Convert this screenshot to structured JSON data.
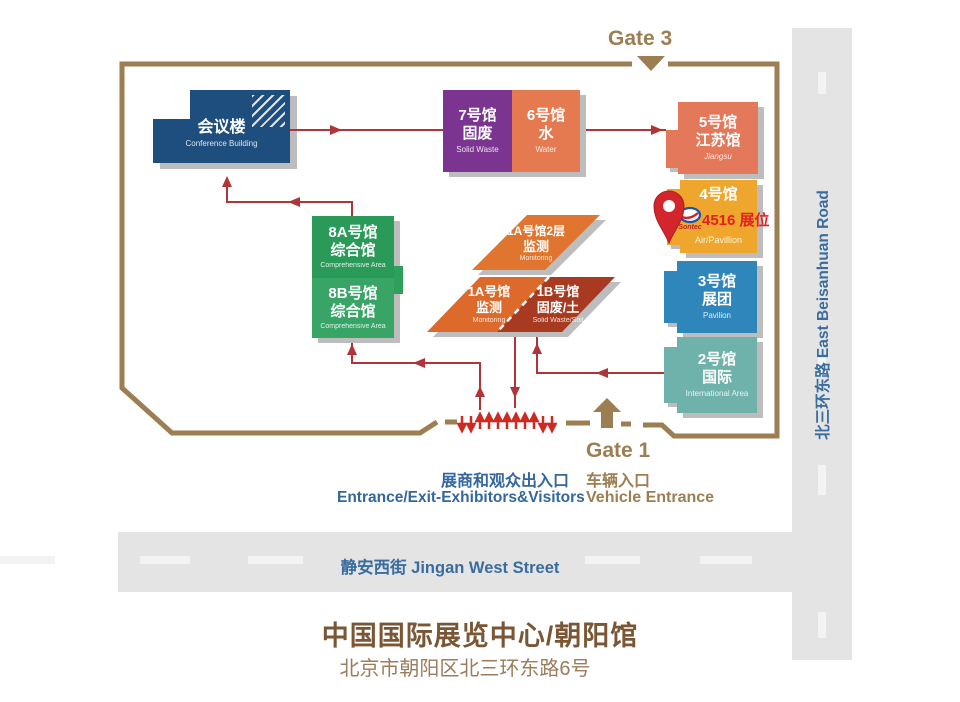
{
  "palette": {
    "border_tan": "#9c7e52",
    "route_red": "#b03438",
    "accent_red": "#d2262c",
    "text_blue": "#33679e",
    "title_brown": "#7b5634",
    "road_gray": "#e4e4e4",
    "hall_conference": "#1e4e7d",
    "hall_7": "#7b3590",
    "hall_6": "#e5794f",
    "hall_5": "#e4785a",
    "hall_4": "#efa62c",
    "hall_3": "#2f86ba",
    "hall_2": "#6fb2ac",
    "hall_8a": "#2a9a59",
    "hall_8b": "#38a567",
    "hall_1a2": "#df752e",
    "hall_1a": "#dd6a2b",
    "hall_1b": "#a73a21"
  },
  "gates": {
    "gate3": "Gate 3",
    "gate1": "Gate 1"
  },
  "halls": {
    "conference": {
      "line1": "会议楼",
      "line3": "Conference Building"
    },
    "h7": {
      "line1": "7号馆",
      "line2": "固废",
      "line3": "Solid Waste"
    },
    "h6": {
      "line1": "6号馆",
      "line2": "水",
      "line3": "Water"
    },
    "h5": {
      "line1": "5号馆",
      "line2": "江苏馆",
      "line3": "Jiangsu"
    },
    "h4": {
      "line1": "4号馆",
      "line3": "Air/Pavillion"
    },
    "h3": {
      "line1": "3号馆",
      "line2": "展团",
      "line3": "Pavilion"
    },
    "h2": {
      "line1": "2号馆",
      "line2": "国际",
      "line3": "International Area"
    },
    "h8a": {
      "line1": "8A号馆",
      "line2": "综合馆",
      "line3": "Comprehensive Area"
    },
    "h8b": {
      "line1": "8B号馆",
      "line2": "综合馆",
      "line3": "Comprehensive Area"
    },
    "h1a2": {
      "line1": "1A号馆2层",
      "line2": "监测",
      "line3": "Monitoring"
    },
    "h1a": {
      "line1": "1A号馆",
      "line2": "监测",
      "line3": "Monitoring"
    },
    "h1b": {
      "line1": "1B号馆",
      "line2": "固废/土",
      "line3": "Solid Waste/Soil"
    }
  },
  "booth": {
    "label": "4516 展位",
    "logo_text": "Sontec"
  },
  "entrance": {
    "cn": "展商和观众出入口",
    "en": "Entrance/Exit-Exhibitors&Visitors"
  },
  "vehicle": {
    "cn": "车辆入口",
    "en": "Vehicle Entrance"
  },
  "streets": {
    "bottom": "静安西街 Jingan West Street",
    "right": "北三环东路 East Beisanhuan Road"
  },
  "footer": {
    "title": "中国国际展览中心/朝阳馆",
    "address": "北京市朝阳区北三环东路6号"
  }
}
